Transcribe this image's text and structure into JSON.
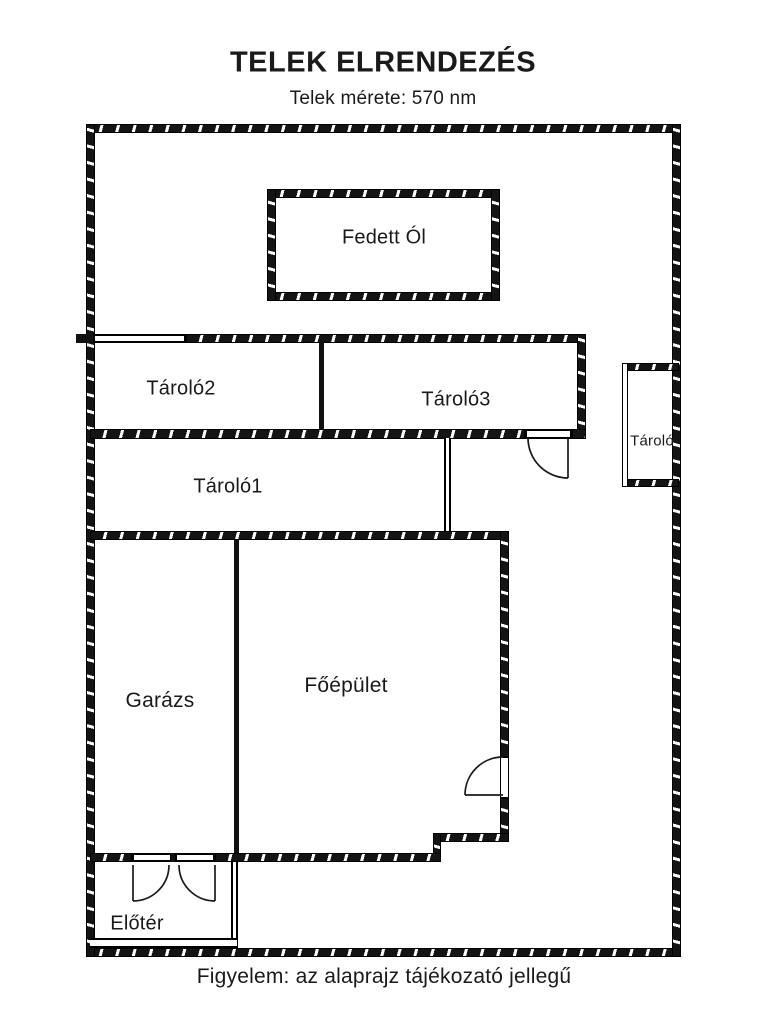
{
  "header": {
    "title": "TELEK ELRENDEZÉS",
    "subtitle": "Telek mérete: 570 nm"
  },
  "plan": {
    "rooms": {
      "fedett_ol": "Fedett Ól",
      "tarolo2": "Tároló2",
      "tarolo3": "Tároló3",
      "tarolo_small": "Tároló",
      "tarolo1": "Tároló1",
      "garazs": "Garázs",
      "foepulet": "Főépület",
      "eloter": "Előtér"
    }
  },
  "footer": {
    "note": "Figyelem: az alaprajz tájékozató jellegű"
  },
  "colors": {
    "line": "#111111",
    "text": "#1a1a1a",
    "background": "#ffffff"
  }
}
